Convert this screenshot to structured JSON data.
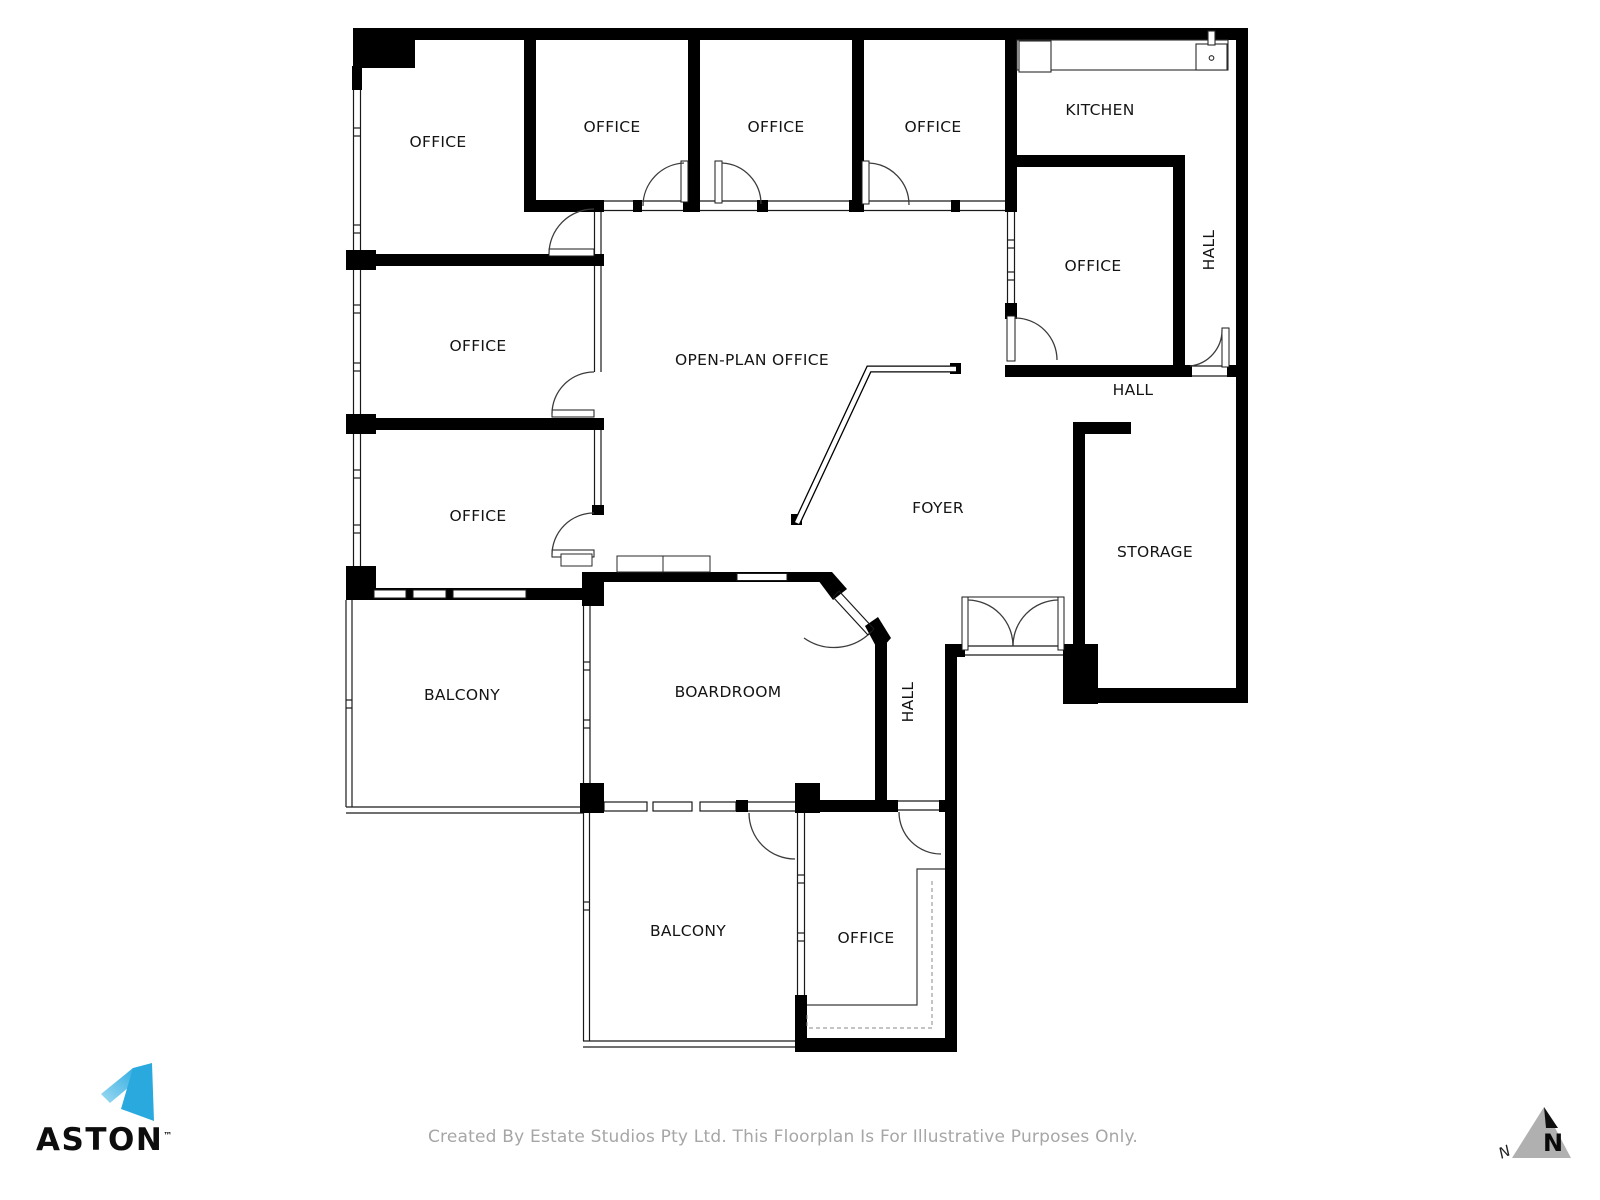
{
  "rooms": {
    "office_a": {
      "label": "OFFICE"
    },
    "office_b": {
      "label": "OFFICE"
    },
    "office_c": {
      "label": "OFFICE"
    },
    "office_d": {
      "label": "OFFICE"
    },
    "kitchen": {
      "label": "KITCHEN"
    },
    "office_right": {
      "label": "OFFICE"
    },
    "hall_right_v": {
      "label": "HALL"
    },
    "hall_right_h": {
      "label": "HALL"
    },
    "office_mid_left": {
      "label": "OFFICE"
    },
    "open_plan": {
      "label": "OPEN-PLAN OFFICE"
    },
    "office_low_left": {
      "label": "OFFICE"
    },
    "foyer": {
      "label": "FOYER"
    },
    "storage": {
      "label": "STORAGE"
    },
    "balcony_left": {
      "label": "BALCONY"
    },
    "boardroom": {
      "label": "BOARDROOM"
    },
    "hall_lower_v": {
      "label": "HALL"
    },
    "balcony_bottom": {
      "label": "BALCONY"
    },
    "office_bottom": {
      "label": "OFFICE"
    }
  },
  "branding": {
    "name": "ASTON",
    "trademark": "™",
    "accent_color": "#2aa9df"
  },
  "compass": {
    "big_n": "N",
    "small_n": "N"
  },
  "footer": {
    "disclaimer": "Created By Estate Studios Pty Ltd. This Floorplan Is For Illustrative Purposes Only."
  }
}
